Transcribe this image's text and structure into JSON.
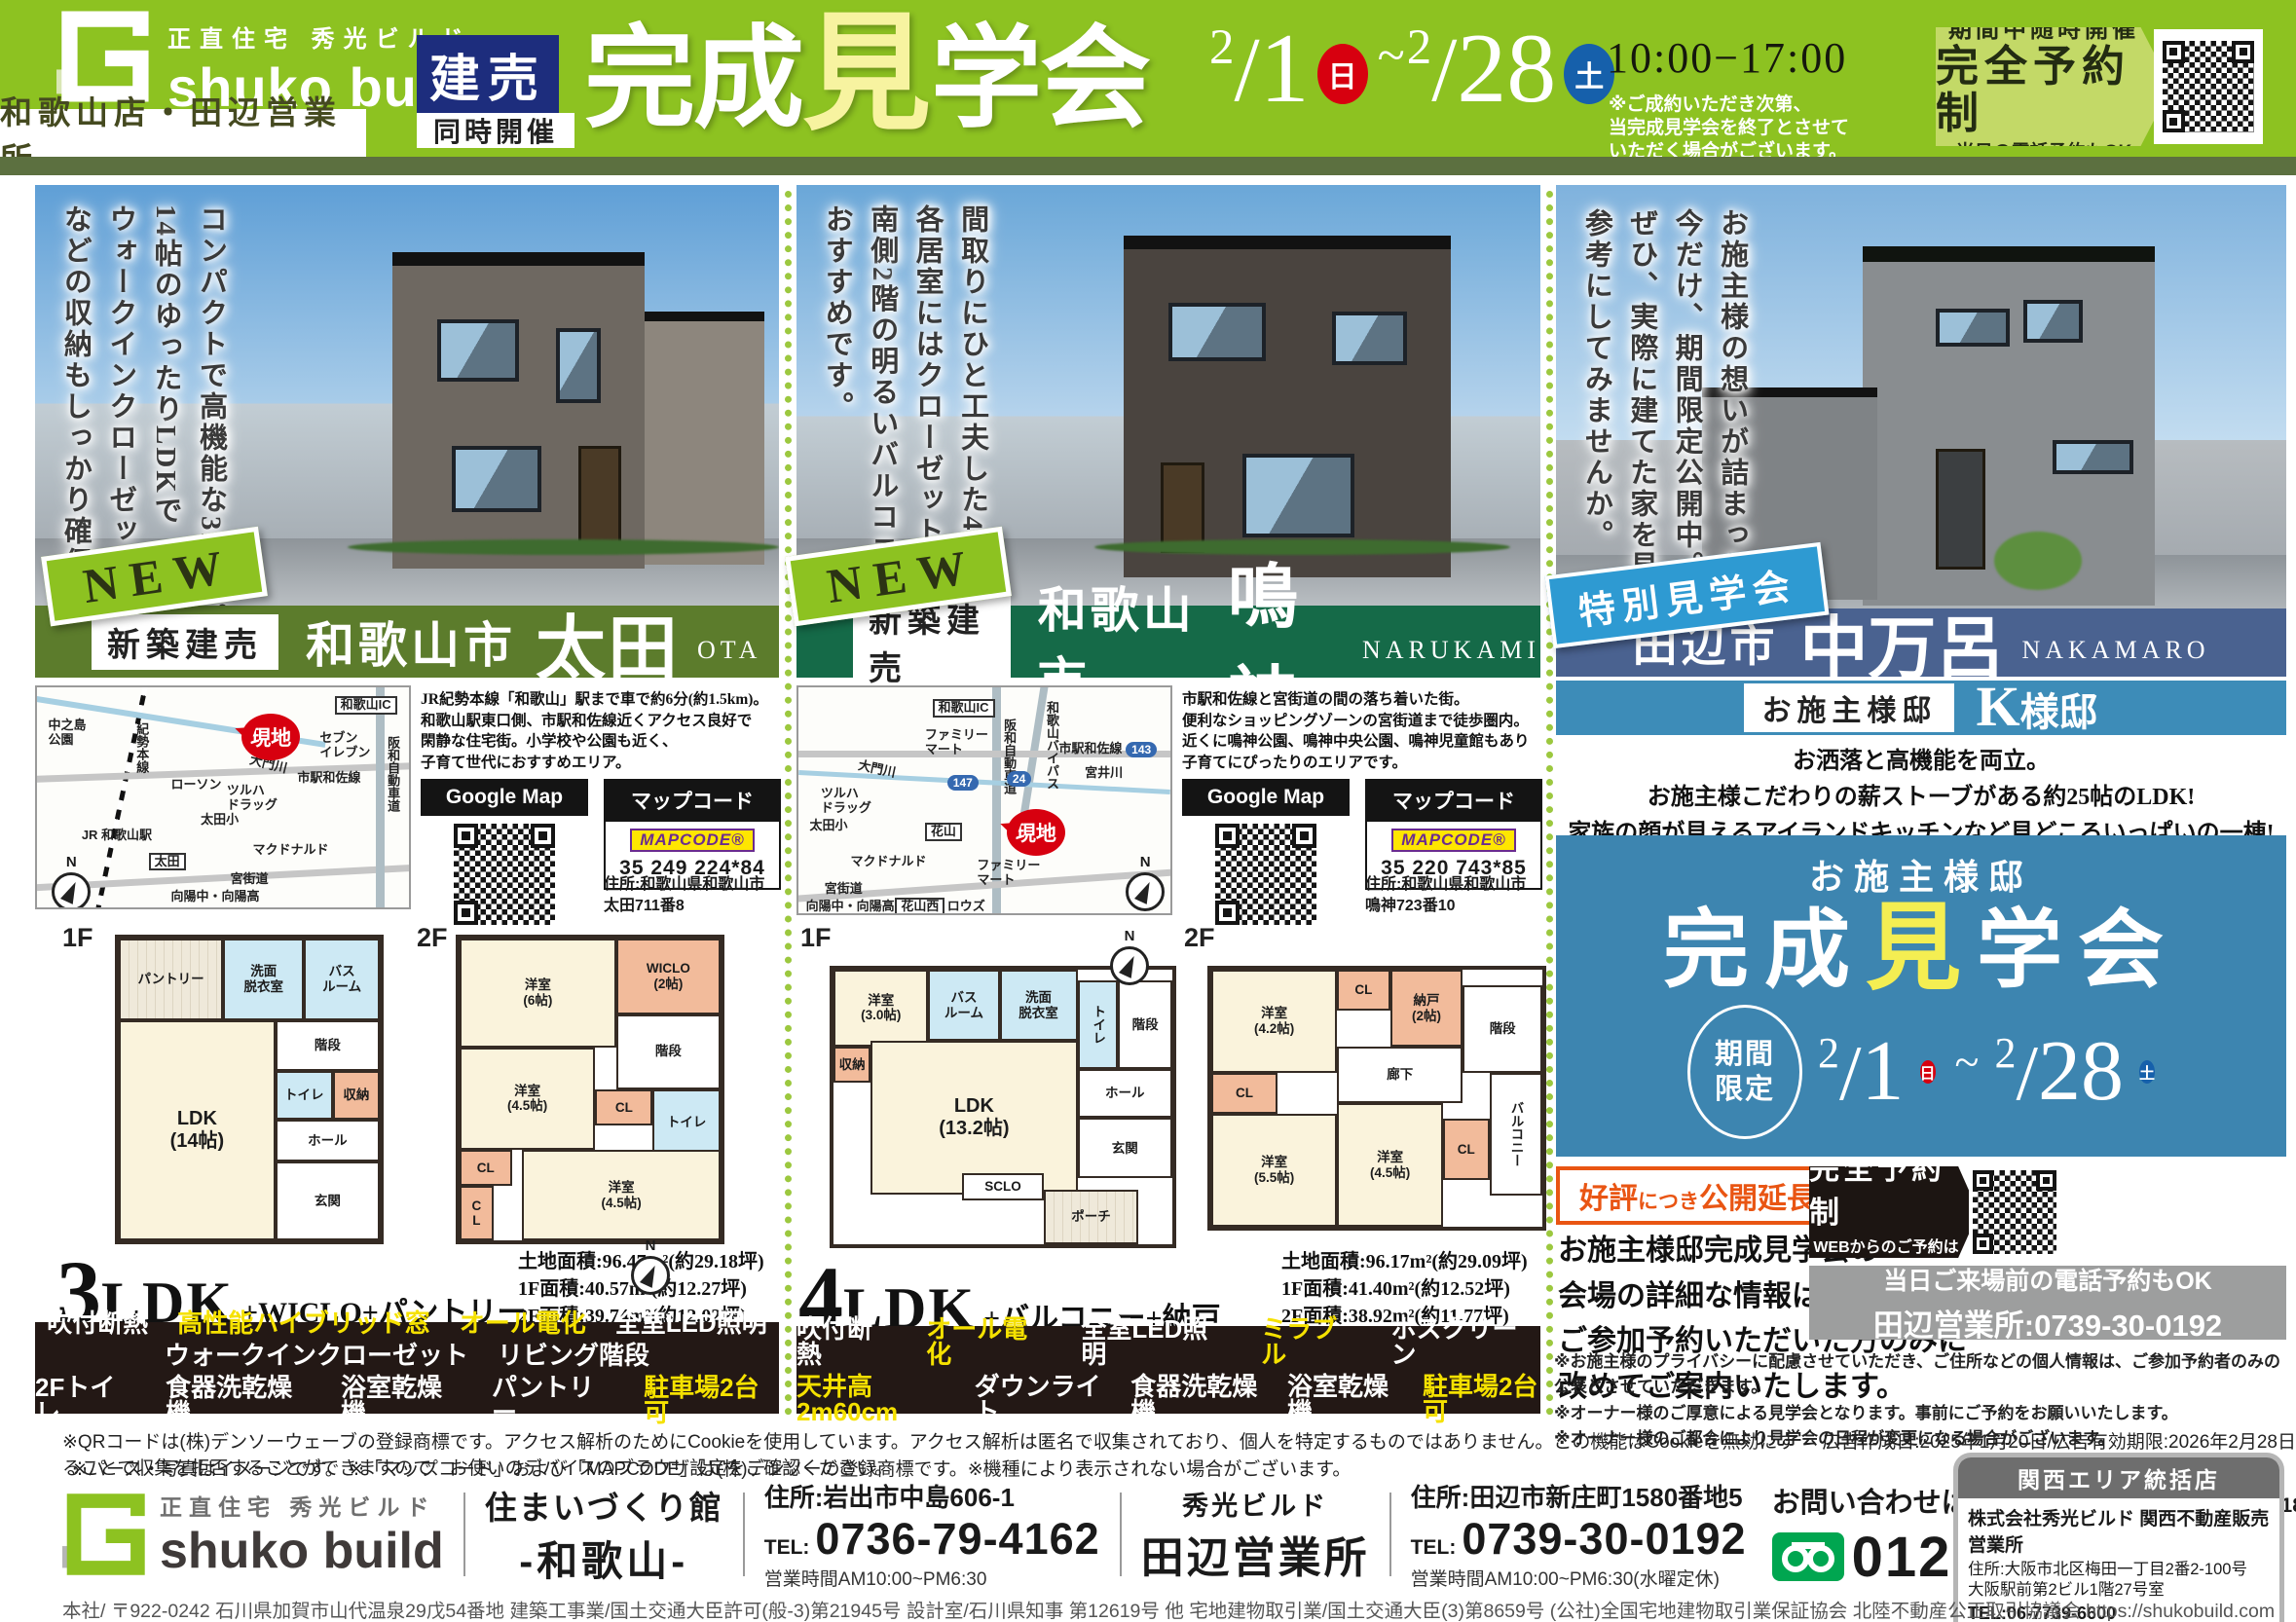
{
  "colors": {
    "brand_green": "#8dc221",
    "olive_band": "#5c7040",
    "sale_navy": "#1d2d7d",
    "bar_ota_green": "#5c7c2c",
    "bar_narukami_green": "#156a48",
    "bar_tanabe_navy": "#4a6290",
    "bar_tanabe_blue": "#3d8cb8",
    "event_blue": "#3d85b0",
    "special_badge_blue": "#2e9ad2",
    "highlight_yellow": "#f5e100",
    "sunday_red": "#d7000f",
    "saturday_blue": "#1660ab",
    "extend_orange": "#e95513",
    "specs_bg": "#231815",
    "freedial_green": "#00a650"
  },
  "header": {
    "brand_top": "正直住宅 秀光ビルド",
    "brand_name": "shuko build",
    "branch": "和歌山店・田辺営業所",
    "sale_badge": "建売",
    "sub_badge": "同時開催",
    "title_pre": "完成",
    "title_mid": "見",
    "title_post": "学会",
    "date_from_month": "2",
    "date_from_day": "1",
    "date_from_wd": "日",
    "tilde": "~",
    "date_to_month": "2",
    "date_to_day": "28",
    "date_to_wd": "土",
    "hours": "10:00−17:00",
    "note": "※ご成約いただき次第、\n当完成見学会を終了とさせて\nいただく場合がございます。",
    "reserve": {
      "l1": "期間中随時開催",
      "l2": "完全予約制",
      "l3": "当日の電話予約もOK"
    }
  },
  "panels": [
    {
      "badge": "NEW",
      "catch": "コンパクトで高機能な3LDK。\n14帖のゆったりLDKで\nウォークインクローゼット\nなどの収納もしっかり確保。",
      "label": "新築建売",
      "city": "和歌山市",
      "name": "太田",
      "romaji": "OTA",
      "map_labels": [
        "中之島\n公園",
        "紀勢本線",
        "JR 和歌山駅",
        "太田",
        "ローソン",
        "ツルハ\nドラッグ",
        "太田小",
        "マクドナルド",
        "宮街道",
        "向陽中・向陽高",
        "現地",
        "セブン\nイレブン",
        "市駅和佐線",
        "大門川",
        "和歌山IC",
        "阪和自動車道",
        "N"
      ],
      "description": "JR紀勢本線「和歌山」駅まで車で約6分(約1.5km)。\n和歌山駅東口側、市駅和佐線近くアクセス良好で\n閑静な住宅街。小学校や公園も近く、\n子育て世代におすすめエリア。",
      "googlemap_label": "Google Map",
      "mapcode_label": "マップコード",
      "mapcode_brand": "MAPCODE®",
      "mapcode": "35 249 224*84",
      "address": "住所:和歌山県和歌山市\n太田711番8",
      "floor1_label": "1F",
      "floor2_label": "2F",
      "compass": "N",
      "rooms1": [
        "パントリー",
        "洗面\n脱衣室",
        "バス\nルーム",
        "階段",
        "トイレ",
        "収納",
        "ホール",
        "玄関",
        "LDK\n(14帖)"
      ],
      "rooms2": [
        "洋室\n(6帖)",
        "WICLO\n(2帖)",
        "階段",
        "洋室\n(4.5帖)",
        "CL",
        "トイレ",
        "CL",
        "C\nL",
        "洋室\n(4.5帖)"
      ],
      "type_num": "3",
      "type_ldk": "LDK",
      "type_suffix": "+WICLO+パントリー",
      "areas": "土地面積:96.47m²(約29.18坪)\n1F面積:40.57m²(約12.27坪)\n2F面積:39.74m²(約12.02坪)",
      "specs": [
        [
          {
            "t": "吹付断熱",
            "hl": false
          },
          {
            "t": "高性能ハイブリッド窓",
            "hl": true
          },
          {
            "t": "オール電化",
            "hl": true
          },
          {
            "t": "全室LED照明",
            "hl": false
          }
        ],
        [
          {
            "t": "ウォークインクローゼット",
            "hl": false
          },
          {
            "t": "リビング階段",
            "hl": false
          }
        ],
        [
          {
            "t": "2Fトイレ",
            "hl": false
          },
          {
            "t": "食器洗乾燥機",
            "hl": false
          },
          {
            "t": "浴室乾燥機",
            "hl": false
          },
          {
            "t": "パントリー",
            "hl": false
          },
          {
            "t": "駐車場2台可",
            "hl": true
          }
        ]
      ]
    },
    {
      "badge": "NEW",
      "catch": "間取りにひと工夫した4LDK。\n各居室にはクローゼットを設置。\n南側2階の明るいバルコニーも\nおすすめです。",
      "label": "新築建売",
      "city": "和歌山市",
      "name": "鳴神",
      "romaji": "NARUKAMI",
      "map_labels": [
        "和歌山IC",
        "阪和自動車道",
        "和歌山バイパス",
        "ファミリー\nマート",
        "市駅和佐線",
        "143",
        "大門川",
        "147",
        "24",
        "宮井川",
        "ツルハ\nドラッグ",
        "太田小",
        "花山",
        "現地",
        "マクドナルド",
        "ファミリー\nマート",
        "宮街道",
        "向陽中・向陽高",
        "花山西",
        "ロウズ",
        "N"
      ],
      "description": "市駅和佐線と宮街道の間の落ち着いた街。\n便利なショッピングゾーンの宮街道まで徒歩圏内。\n近くに鳴神公園、鳴神中央公園、鳴神児童館もあり\n子育てにぴったりのエリアです。",
      "googlemap_label": "Google Map",
      "mapcode_label": "マップコード",
      "mapcode_brand": "MAPCODE®",
      "mapcode": "35 220 743*85",
      "address": "住所:和歌山県和歌山市\n鳴神723番10",
      "floor1_label": "1F",
      "floor2_label": "2F",
      "compass": "N",
      "rooms1": [
        "洋室\n(3.0帖)",
        "バス\nルーム",
        "洗面\n脱衣室",
        "トイレ",
        "階段",
        "収納",
        "収納",
        "LDK\n(13.2帖)",
        "ホール",
        "玄関",
        "SCLO",
        "ポーチ"
      ],
      "rooms2": [
        "洋室\n(4.2帖)",
        "CL",
        "納戸\n(2帖)",
        "階段",
        "CL",
        "廊下",
        "洋室\n(5.5帖)",
        "洋室\n(4.5帖)",
        "CL",
        "バルコニー"
      ],
      "type_num": "4",
      "type_ldk": "LDK",
      "type_suffix": "+バルコニー+納戸",
      "areas": "土地面積:96.17m²(約29.09坪)\n1F面積:41.40m²(約12.52坪)\n2F面積:38.92m²(約11.77坪)",
      "specs": [
        [
          {
            "t": "吹付断熱",
            "hl": false
          },
          {
            "t": "オール電化",
            "hl": true
          },
          {
            "t": "全室LED照明",
            "hl": false
          },
          {
            "t": "ミラブル",
            "hl": true
          },
          {
            "t": "ホスクリーン",
            "hl": false
          }
        ],
        [
          {
            "t": "天井高2m60cm",
            "hl": true
          },
          {
            "t": "ダウンライト",
            "hl": false
          },
          {
            "t": "食器洗乾燥機",
            "hl": false
          },
          {
            "t": "浴室乾燥機",
            "hl": false
          },
          {
            "t": "駐車場2台可",
            "hl": true
          }
        ]
      ]
    }
  ],
  "special": {
    "badge": "特別見学会",
    "catch": "お施主様の想いが詰まった家。\n今だけ、期間限定公開中。\nぜひ、実際に建てた家を見て\n参考にしてみませんか。",
    "city": "田辺市",
    "name": "中万呂",
    "romaji": "NAKAMARO",
    "owner_label": "お施主様邸",
    "owner_name": "K",
    "owner_suffix": "様邸",
    "lead": "お洒落と高機能を両立。\nお施主様こだわりの薪ストーブがある約25帖のLDK!\n家族の顔が見えるアイランドキッチンなど見どころいっぱいの一棟!",
    "event": {
      "owner": "お施主様邸",
      "title_pre": "完成",
      "title_mid": "見",
      "title_post": "学会",
      "period": "期間\n限定",
      "date_from_month": "2",
      "date_from_day": "1",
      "date_from_wd": "日",
      "tilde": "~",
      "date_to_month": "2",
      "date_to_day": "28",
      "date_to_wd": "土",
      "hours": "10:00−17:00"
    },
    "extend": {
      "p1": "好評",
      "p2": "につき",
      "p3": "公開延長!"
    },
    "info": "お施主様邸完成見学会の\n会場の詳細な情報は\nご参加予約いただいた方のみに\n改めてご案内いたします。",
    "reserve": {
      "title": "完全予約制",
      "sub": "WEBからのご予約は\nQRコードから"
    },
    "phone_box": {
      "l1": "当日ご来場前の電話予約もOK",
      "l2": "田辺営業所:0739-30-0192"
    },
    "notes": "※お施主様のプライバシーに配慮させていただき、ご住所などの個人情報は、ご参加予約者のみの公表とさせていただきます。\n※オーナー様のご厚意による見学会となります。事前にご予約をお願いいたします。\n※オーナー様のご都合により見学会の日程が変更になる場合がございます。"
  },
  "legal": {
    "line1": "※QRコードは(株)デンソーウェーブの登録商標です。アクセス解析のためにCookieを使用しています。アクセス解析は匿名で収集されており、個人を特定するものではありません。この機能はCookieを無効にすることで収集を拒否することができますので、お使いのデバイスのブラウザ設定をご確認ください。",
    "ad_date": "広告作成日:2025年1月20日/広告有効期限:2026年2月28日",
    "line2": "※パース・写真はイメージです。 ※「マップコード」および「MAPCODE」は(株)デンソーの登録商標です。※機種により表示されない場合がございます。"
  },
  "footer": {
    "brand_top": "正直住宅 秀光ビルド",
    "brand_name": "shuko build",
    "hall_l1": "住まいづくり館",
    "hall_l2": "-和歌山-",
    "wakayama": {
      "addr": "住所:岩出市中島606-1",
      "tel_label": "TEL:",
      "tel": "0736-79-4162",
      "hours": "営業時間AM10:00~PM6:30"
    },
    "tanabe_title_l1": "秀光ビルド",
    "tanabe_title_l2": "田辺営業所",
    "tanabe": {
      "addr": "住所:田辺市新庄町1580番地5",
      "tel_label": "TEL:",
      "tel": "0739-30-0192",
      "hours": "営業時間AM10:00~PM6:30(水曜定休)"
    },
    "contact": {
      "label": "お問い合わせはこちらまで",
      "hours": "営業時間:10:00~18:30",
      "freedial": "0120-333-289"
    },
    "kansai": {
      "title": "関西エリア統括店",
      "company": "株式会社秀光ビルド 関西不動産販売営業所",
      "addr": "住所:大阪市北区梅田一丁目2番2-100号\n大阪駅前第2ビル1階27号室",
      "tel": "TEL:06-7739-6600",
      "license": "宅地建物取引業/国土交通大臣(3)第8659号"
    },
    "company_line": "本社/ 〒922-0242 石川県加賀市山代温泉29戊54番地 建築工事業/国土交通大臣許可(般-3)第21945号 設計室/石川県知事 第12619号 他 宅地建物取引業/国土交通大臣(3)第8659号 (公社)全国宅地建物取引業保証協会 北陸不動産公正取引協議会 https://shukobuild.com"
  }
}
